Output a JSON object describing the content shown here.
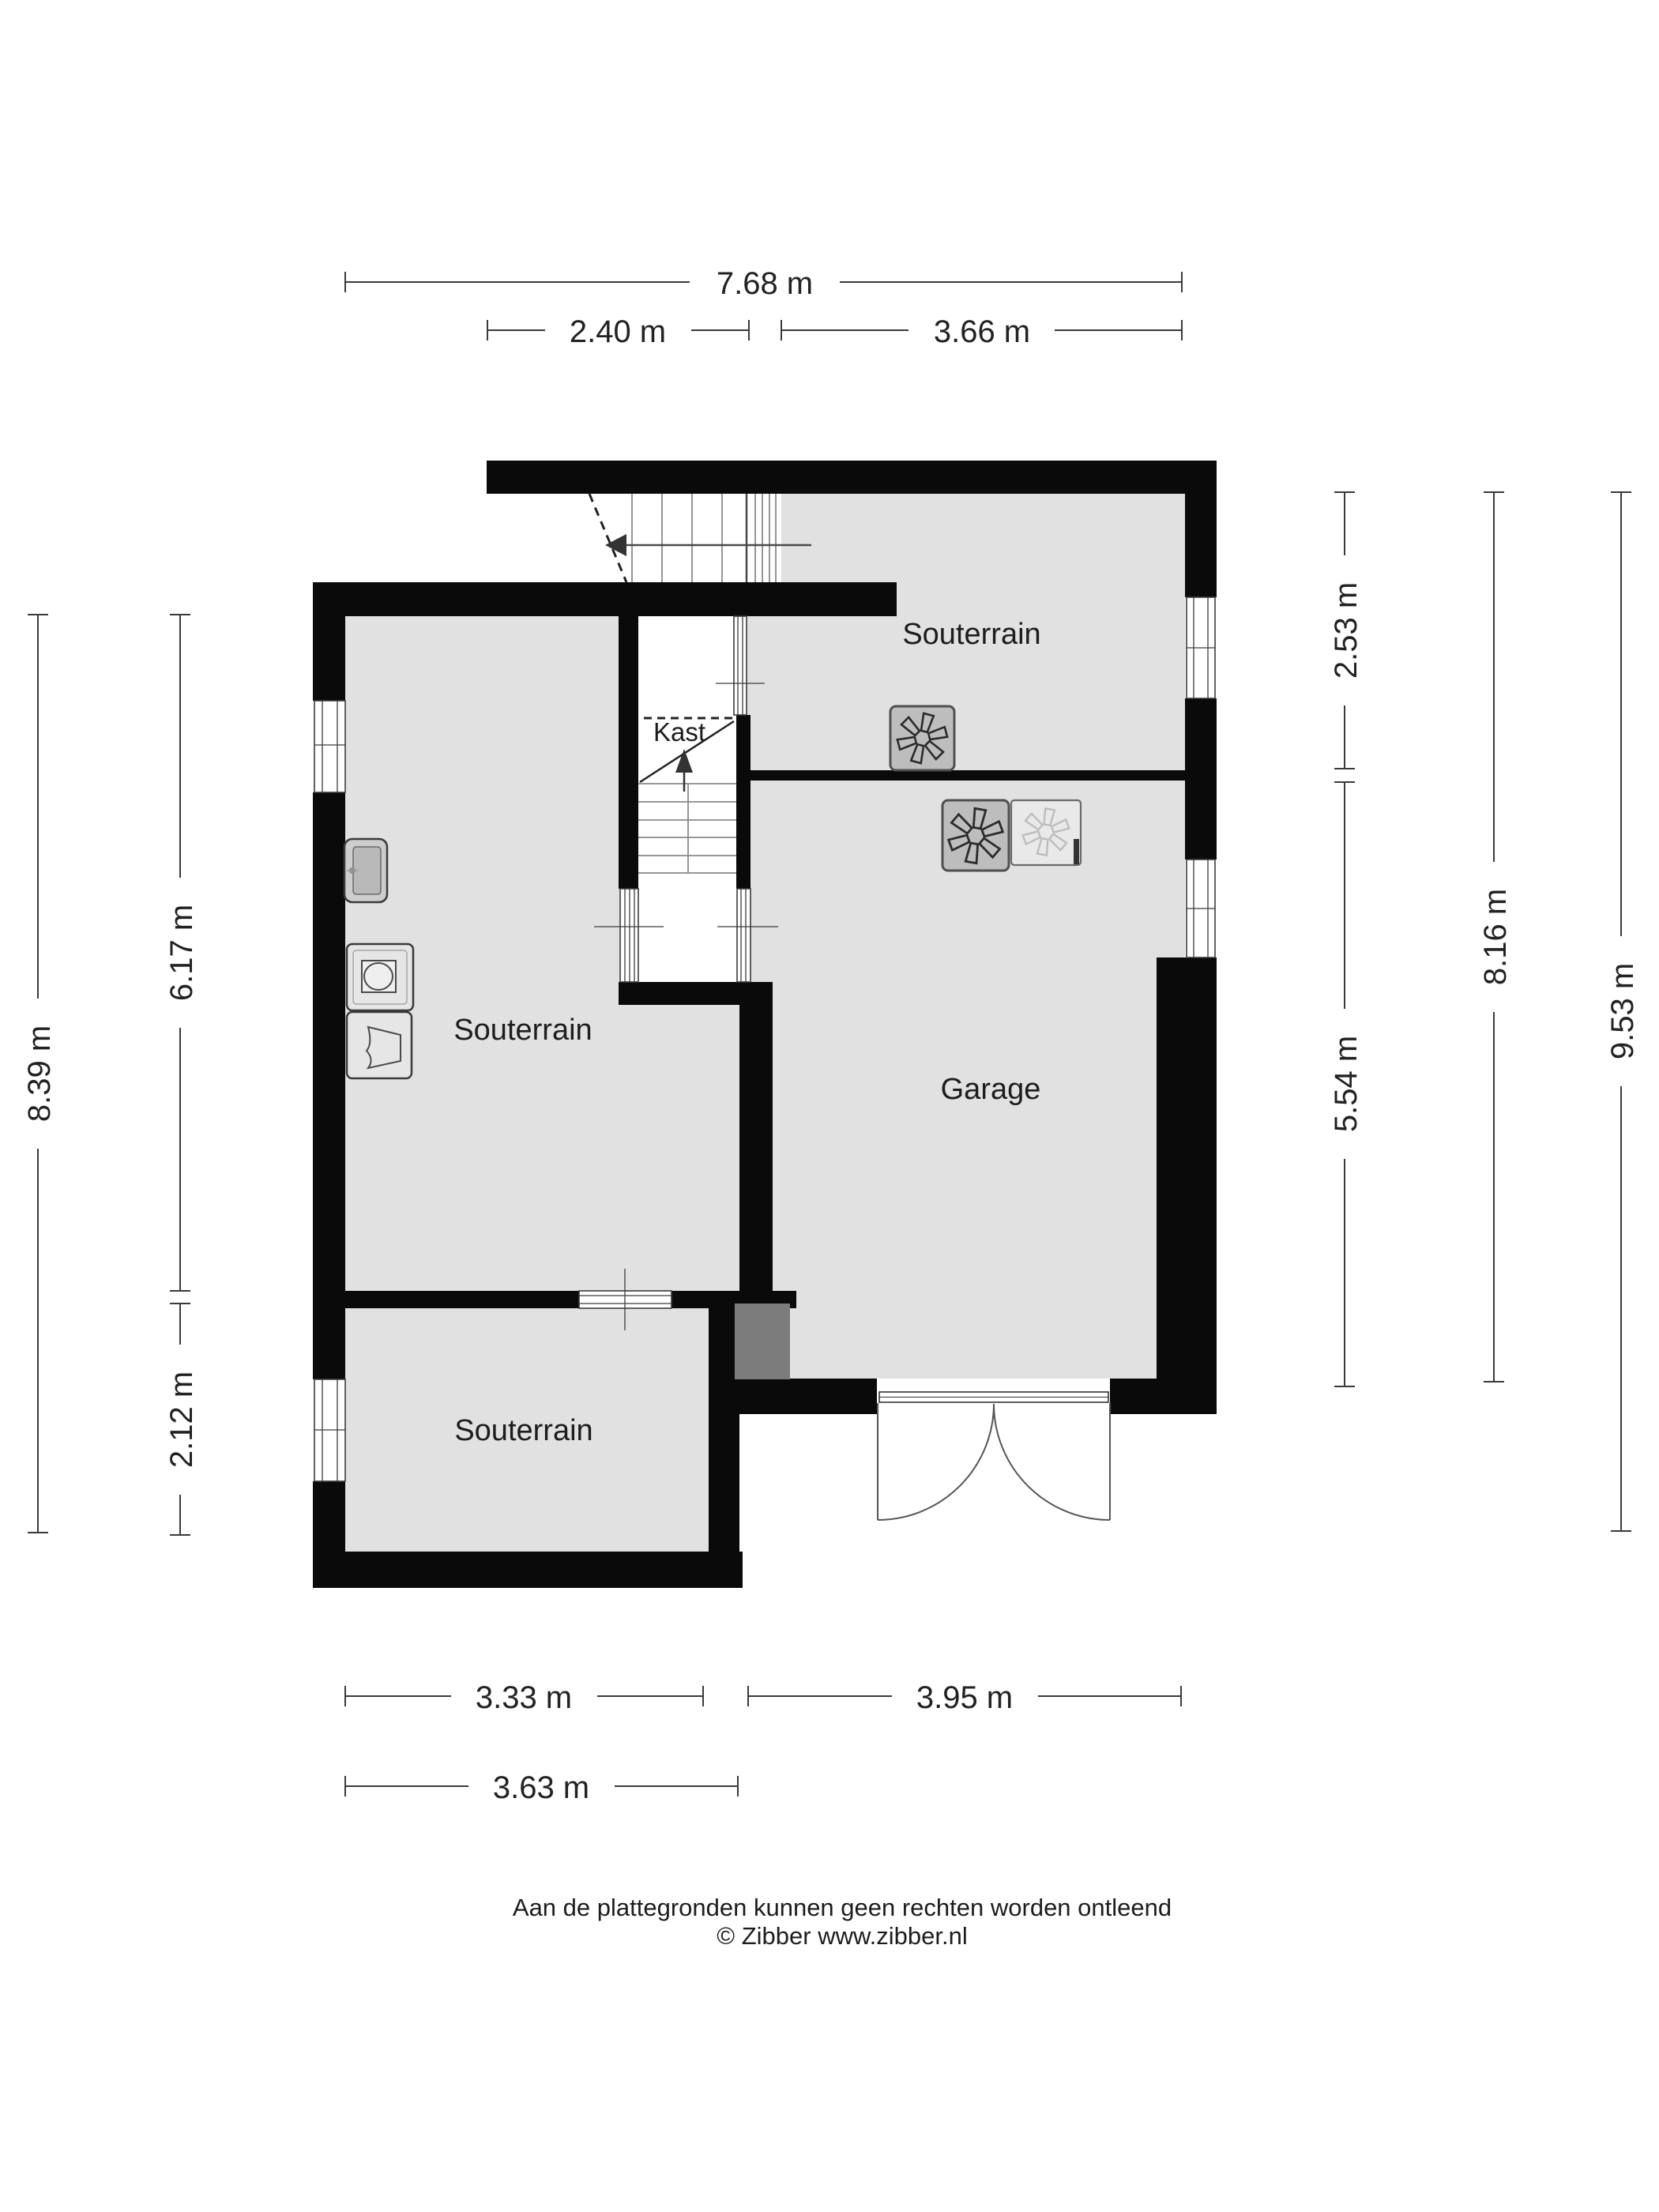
{
  "colors": {
    "background": "#ffffff",
    "wall": "#0a0a0a",
    "floor": "#e1e1e1",
    "duct_block": "#7c7c7c",
    "vent_dark_fill": "#bdbdbd",
    "vent_light_fill": "#e9e9e9",
    "text": "#1d1d1d",
    "dimension_line": "#3a3a3a"
  },
  "plan": {
    "rooms": [
      {
        "id": "souterrain-top",
        "label": "Souterrain"
      },
      {
        "id": "souterrain-left",
        "label": "Souterrain"
      },
      {
        "id": "souterrain-bottom",
        "label": "Souterrain"
      },
      {
        "id": "garage",
        "label": "Garage"
      },
      {
        "id": "kast",
        "label": "Kast"
      }
    ],
    "dimensions": {
      "top": [
        {
          "label": "7.68 m"
        },
        {
          "label": "2.40 m"
        },
        {
          "label": "3.66 m"
        }
      ],
      "left": [
        {
          "label": "8.39 m"
        },
        {
          "label": "6.17 m"
        },
        {
          "label": "2.12 m"
        }
      ],
      "right": [
        {
          "label": "2.53 m"
        },
        {
          "label": "5.54 m"
        },
        {
          "label": "8.16 m"
        },
        {
          "label": "9.53 m"
        }
      ],
      "bottom": [
        {
          "label": "3.33 m"
        },
        {
          "label": "3.95 m"
        },
        {
          "label": "3.63 m"
        }
      ]
    },
    "icons": [
      {
        "name": "fan-vent-icon",
        "count": 3
      },
      {
        "name": "sink-icon",
        "count": 1
      },
      {
        "name": "washing-machine-icon",
        "count": 1
      },
      {
        "name": "laundry-basket-icon",
        "count": 1
      },
      {
        "name": "stairs-arrow-icon",
        "count": 2
      },
      {
        "name": "double-garage-door-icon",
        "count": 1
      }
    ]
  },
  "footer": {
    "line1": "Aan de plattegronden kunnen geen rechten worden ontleend",
    "line2": "© Zibber www.zibber.nl"
  }
}
